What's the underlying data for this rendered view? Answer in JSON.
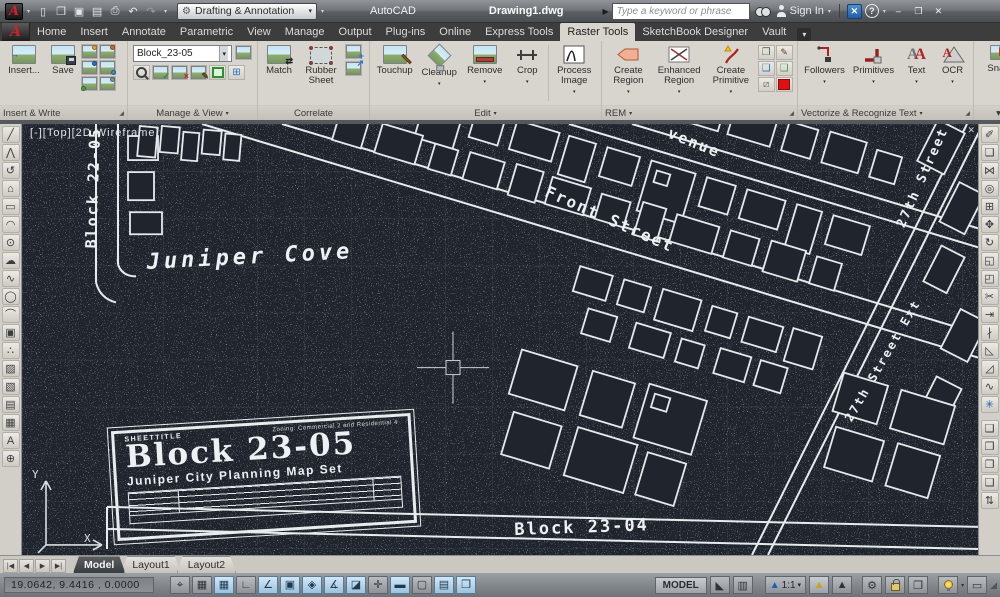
{
  "colors": {
    "accent_red": "#cf2128",
    "canvas_bg": "#20242d",
    "active_toggle_blue": "#9cc3e0"
  },
  "titlebar": {
    "app_title": "AutoCAD",
    "document_title": "Drawing1.dwg",
    "workspace": "Drafting & Annotation",
    "search_placeholder": "Type a keyword or phrase",
    "sign_in_label": "Sign In"
  },
  "icons": {
    "app_logo": "A",
    "caret": "▾",
    "doc_arrow": "▶",
    "help": "?",
    "minimize": "–",
    "maximize": "❐",
    "close": "✕",
    "exchange": "✕",
    "gear": "⚙",
    "launcher": "◢",
    "flyout": "▾"
  },
  "qat": {
    "items": [
      {
        "name": "new-file-icon",
        "glyph": "▯"
      },
      {
        "name": "open-file-icon",
        "glyph": "❐"
      },
      {
        "name": "save-icon",
        "glyph": "▣"
      },
      {
        "name": "save-as-icon",
        "glyph": "▤"
      },
      {
        "name": "plot-icon",
        "glyph": "⎙"
      },
      {
        "name": "undo-icon",
        "glyph": "↶"
      },
      {
        "name": "redo-icon",
        "glyph": "↷",
        "state": "dim"
      }
    ]
  },
  "ribbon": {
    "tabs": [
      {
        "label": "Home"
      },
      {
        "label": "Insert"
      },
      {
        "label": "Annotate"
      },
      {
        "label": "Parametric"
      },
      {
        "label": "View"
      },
      {
        "label": "Manage"
      },
      {
        "label": "Output"
      },
      {
        "label": "Plug-ins"
      },
      {
        "label": "Online"
      },
      {
        "label": "Express Tools"
      },
      {
        "label": "Raster Tools",
        "state": "active"
      },
      {
        "label": "SketchBook Designer"
      },
      {
        "label": "Vault"
      }
    ],
    "panels": {
      "insert_write": {
        "label": "Insert & Write",
        "insert_label": "Insert...",
        "save_label": "Save"
      },
      "manage_view": {
        "label": "Manage & View",
        "image_select": "Block_23-05"
      },
      "correlate": {
        "label": "Correlate",
        "match_label": "Match",
        "rubber_sheet_label": "Rubber Sheet"
      },
      "edit": {
        "label": "Edit",
        "touchup": "Touchup",
        "cleanup": "Cleanup",
        "remove": "Remove",
        "crop": "Crop",
        "process_image": "Process Image"
      },
      "rem": {
        "label": "REM",
        "create_region": "Create Region",
        "enhanced_region": "Enhanced Region",
        "create_primitive": "Create Primitive"
      },
      "vectorize": {
        "label": "Vectorize & Recognize Text",
        "followers": "Followers",
        "primitives": "Primitives",
        "text": "Text",
        "ocr": "OCR",
        "letter_glyph": "A"
      },
      "snap": {
        "label": "▾",
        "snap_label": "Snap"
      }
    }
  },
  "toolbars": {
    "draw": [
      {
        "name": "line-icon",
        "glyph": "╱"
      },
      {
        "name": "polyline-icon",
        "glyph": "⋀"
      },
      {
        "name": "revision-icon",
        "glyph": "↺"
      },
      {
        "name": "polygon-icon",
        "glyph": "⌂"
      },
      {
        "name": "rectangle-icon",
        "glyph": "▭"
      },
      {
        "name": "arc-icon",
        "glyph": "◠"
      },
      {
        "name": "circle-icon",
        "glyph": "⊙"
      },
      {
        "name": "revcloud-icon",
        "glyph": "☁"
      },
      {
        "name": "spline-icon",
        "glyph": "∿"
      },
      {
        "name": "ellipse-icon",
        "glyph": "◯"
      },
      {
        "name": "ellipse-arc-icon",
        "glyph": "⌒"
      },
      {
        "name": "insert-block-icon",
        "glyph": "▣"
      },
      {
        "name": "point-icon",
        "glyph": "∴"
      },
      {
        "name": "hatch-icon",
        "glyph": "▨"
      },
      {
        "name": "gradient-icon",
        "glyph": "▧"
      },
      {
        "name": "region-icon",
        "glyph": "▤"
      },
      {
        "name": "table-icon",
        "glyph": "▦"
      },
      {
        "name": "mtext-icon",
        "glyph": "A"
      },
      {
        "name": "add-selected-icon",
        "glyph": "⊕"
      }
    ],
    "modify": [
      {
        "name": "erase-icon",
        "glyph": "✐"
      },
      {
        "name": "copy-icon",
        "glyph": "❏"
      },
      {
        "name": "mirror-icon",
        "glyph": "⋈"
      },
      {
        "name": "offset-icon",
        "glyph": "◎"
      },
      {
        "name": "array-icon",
        "glyph": "⊞"
      },
      {
        "name": "move-icon",
        "glyph": "✥"
      },
      {
        "name": "rotate-icon",
        "glyph": "↻"
      },
      {
        "name": "scale-icon",
        "glyph": "◱"
      },
      {
        "name": "stretch-icon",
        "glyph": "◰"
      },
      {
        "name": "trim-icon",
        "glyph": "✂"
      },
      {
        "name": "extend-icon",
        "glyph": "⇥"
      },
      {
        "name": "break-icon",
        "glyph": "∤"
      },
      {
        "name": "chamfer-icon",
        "glyph": "◺"
      },
      {
        "name": "fillet-icon",
        "glyph": "◿"
      },
      {
        "name": "blend-icon",
        "glyph": "∿"
      },
      {
        "name": "explode-icon",
        "glyph": "✳",
        "state": "blue"
      },
      {
        "name": "separator",
        "glyph": "",
        "state": "sep"
      },
      {
        "name": "bring-to-front-icon",
        "glyph": "❑"
      },
      {
        "name": "send-to-back-icon",
        "glyph": "❒"
      },
      {
        "name": "bring-above-icon",
        "glyph": "❐"
      },
      {
        "name": "send-under-icon",
        "glyph": "❏"
      },
      {
        "name": "text-to-front-icon",
        "glyph": "⇅"
      }
    ]
  },
  "canvas": {
    "viewport_label": "[-][Top][2D Wireframe]",
    "toolbar_close_glyph": "✕",
    "labels": {
      "juniper_cove": "Juniper Cove",
      "front_street": "Front Street",
      "avenue_fragment": "venue",
      "street_27": "27th Street",
      "street_27_ext": "27th Street Ext",
      "block_22": "Block 22-05",
      "block_23_04": "Block 23-04"
    },
    "ucs": {
      "x_label": "X",
      "y_label": "Y"
    },
    "titleblock": {
      "sheet_label": "SHEETTITLE",
      "zoning_note": "Zoning: Commercial 2 and Residential 4",
      "title": "Block 23-05",
      "subtitle": "Juniper City Planning Map Set"
    }
  },
  "layout_tabs": {
    "nav": [
      {
        "name": "first-layout-icon",
        "glyph": "|◀"
      },
      {
        "name": "prev-layout-icon",
        "glyph": "◀"
      },
      {
        "name": "next-layout-icon",
        "glyph": "▶"
      },
      {
        "name": "last-layout-icon",
        "glyph": "▶|"
      }
    ],
    "tabs": [
      {
        "label": "Model",
        "state": "active"
      },
      {
        "label": "Layout1"
      },
      {
        "label": "Layout2"
      }
    ]
  },
  "statusbar": {
    "coordinates": "19.0642, 9.4416 , 0.0000",
    "toggles": [
      {
        "name": "infer-constraints-toggle",
        "glyph": "⌖"
      },
      {
        "name": "snap-mode-toggle",
        "glyph": "▦"
      },
      {
        "name": "grid-display-toggle",
        "glyph": "▦",
        "state": "on"
      },
      {
        "name": "ortho-mode-toggle",
        "glyph": "∟"
      },
      {
        "name": "polar-tracking-toggle",
        "glyph": "∠",
        "state": "on"
      },
      {
        "name": "object-snap-toggle",
        "glyph": "▣",
        "state": "on"
      },
      {
        "name": "3d-object-snap-toggle",
        "glyph": "◈",
        "state": "on"
      },
      {
        "name": "object-snap-tracking-toggle",
        "glyph": "∡",
        "state": "on"
      },
      {
        "name": "dynamic-ucs-toggle",
        "glyph": "◪",
        "state": "on"
      },
      {
        "name": "dynamic-input-toggle",
        "glyph": "✛"
      },
      {
        "name": "lineweight-toggle",
        "glyph": "▬",
        "state": "on"
      },
      {
        "name": "transparency-toggle",
        "glyph": "▢"
      },
      {
        "name": "quick-properties-toggle",
        "glyph": "▤",
        "state": "on"
      },
      {
        "name": "selection-cycling-toggle",
        "glyph": "❒",
        "state": "on"
      }
    ],
    "model_label": "MODEL",
    "annotation_scale": "1:1",
    "scale_caret": "▾"
  }
}
